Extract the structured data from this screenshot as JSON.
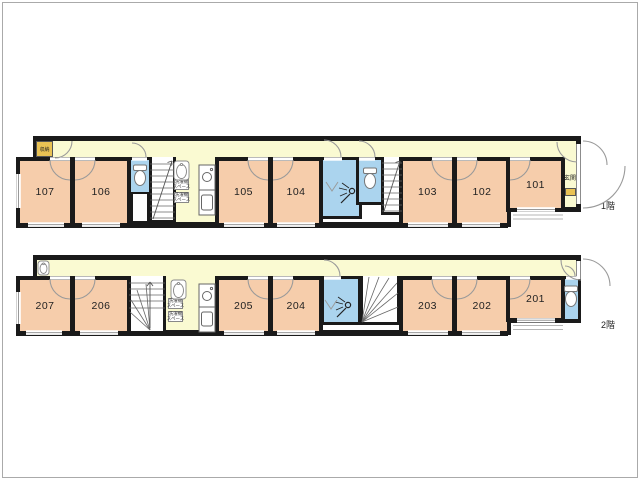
{
  "meta": {
    "floor1_label": "1階",
    "floor2_label": "2階"
  },
  "floor1": {
    "rooms": [
      "107",
      "106",
      "105",
      "104",
      "103",
      "102",
      "101"
    ],
    "storage_label": "収納",
    "entrance_label": "玄関",
    "laundry_line1": "洗濯機",
    "laundry_line2": "スペース"
  },
  "floor2": {
    "rooms": [
      "207",
      "206",
      "205",
      "204",
      "203",
      "202",
      "201"
    ],
    "laundry_line1": "洗濯機",
    "laundry_line2": "スペース"
  },
  "colors": {
    "wall": "#1a1a1a",
    "room_fill": "#f6cdab",
    "hall_fill": "#fafad2",
    "wet_fill": "#abd4ee",
    "cabinet_fill": "#e9c254"
  }
}
